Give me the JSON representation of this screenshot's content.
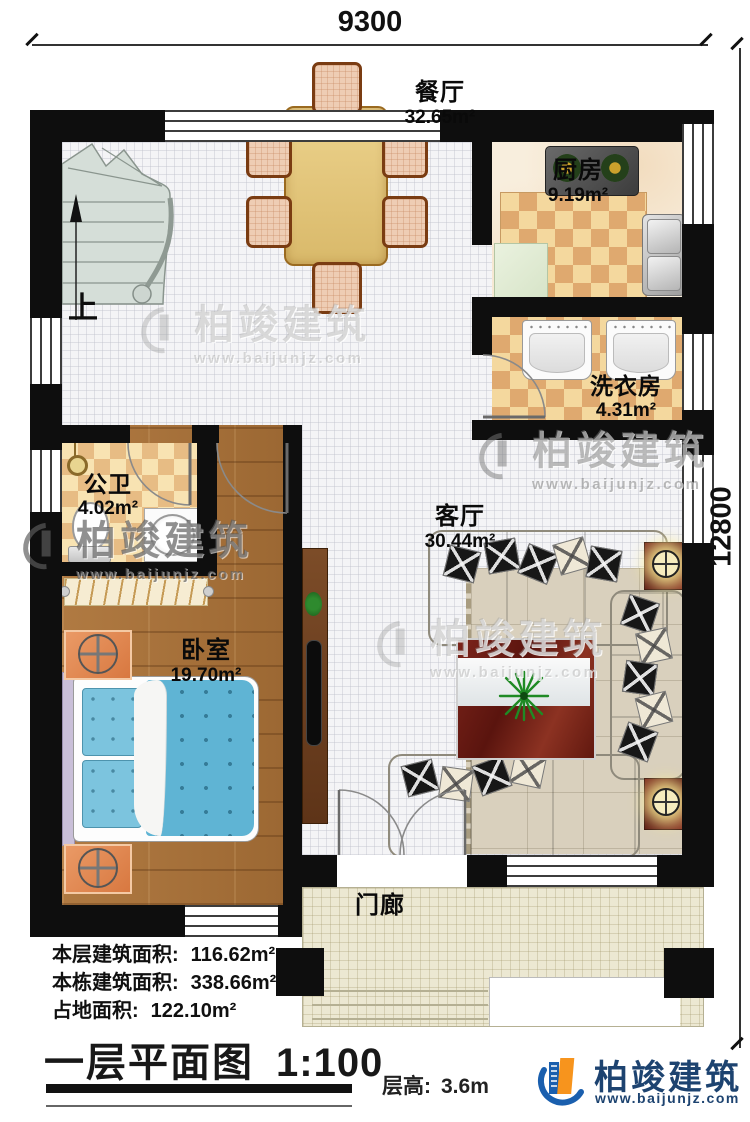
{
  "dimensions": {
    "top": "9300",
    "right": "12800"
  },
  "rooms": {
    "dining": {
      "name": "餐厅",
      "area": "32.65m²"
    },
    "kitchen": {
      "name": "厨房",
      "area": "9.19m²"
    },
    "laundry": {
      "name": "洗衣房",
      "area": "4.31m²"
    },
    "bathroom": {
      "name": "公卫",
      "area": "4.02m²"
    },
    "bedroom": {
      "name": "卧室",
      "area": "19.70m²"
    },
    "living": {
      "name": "客厅",
      "area": "30.44m²"
    },
    "porch": {
      "name": "门廊"
    }
  },
  "stairs": {
    "up_label": "上"
  },
  "stats": {
    "floor_area": {
      "label": "本层建筑面积:",
      "value": "116.62m²"
    },
    "building_area": {
      "label": "本栋建筑面积:",
      "value": "338.66m²"
    },
    "footprint_area": {
      "label": "占地面积:",
      "value": "122.10m²"
    }
  },
  "title": {
    "text": "一层平面图",
    "scale": "1:100"
  },
  "floor_height": {
    "label": "层高:",
    "value": "3.6m"
  },
  "brand": {
    "name": "柏竣建筑",
    "url": "www.baijunjz.com"
  },
  "watermark": {
    "name": "柏竣建筑",
    "url": "www.baijunjz.com"
  },
  "colors": {
    "brand_blue": "#1a5fae",
    "brand_orange": "#f7941d",
    "wall": "#0e0e0e"
  }
}
